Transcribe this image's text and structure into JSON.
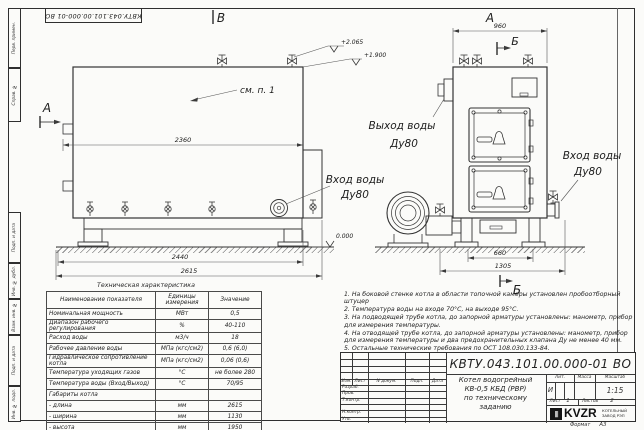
{
  "sheet": {
    "corner_stamp": "КВТУ.043.101.00.000-01 ВО",
    "margin_labels_top": [
      "Перв. примен.",
      "Справ. №"
    ],
    "margin_labels_bottom": [
      "Подп. и дата",
      "Инв. № дубл.",
      "Взам. инв. №",
      "Подп. и дата",
      "Инв. № подл."
    ],
    "format_label": "Формат",
    "format_value": "А3"
  },
  "views": {
    "side": {
      "view_label": "В",
      "section_label": "А",
      "note_ref": "см. п. 1",
      "dim_body": "2360",
      "dim_frame": "2440",
      "dim_overall": "2615",
      "elev_top": "+2.065",
      "elev_nozzle": "+1.900",
      "elev_zero": "0.000",
      "inlet_line1": "Вход воды",
      "inlet_line2": "Ду80"
    },
    "front": {
      "view_label": "А",
      "section_top": "Б",
      "section_bottom": "Б",
      "dim_width": "960",
      "dim_frame": "660",
      "dim_overall": "1305",
      "outlet_line1": "Выход воды",
      "outlet_line2": "Ду80",
      "inlet_line1": "Вход воды",
      "inlet_line2": "Ду80"
    }
  },
  "spec_table": {
    "title": "Техническая характеристика",
    "headers": [
      "Наименование показателя",
      "Единицы измерения",
      "Значение"
    ],
    "rows": [
      [
        "Номинальная мощность",
        "МВт",
        "0,5"
      ],
      [
        "Диапазон рабочего регулирования",
        "%",
        "40-110"
      ],
      [
        "Расход воды",
        "м3/ч",
        "18"
      ],
      [
        "Рабочее давление воды",
        "МПа (кгс/см2)",
        "0,6 (6,0)"
      ],
      [
        "Гидравлическое сопротивление котла",
        "МПа (кгс/см2)",
        "0,06 (0,6)"
      ],
      [
        "Температура уходящих газов",
        "°С",
        "не более 280"
      ],
      [
        "Температура воды (Вход/Выход)",
        "°С",
        "70/95"
      ],
      [
        "Габариты котла",
        "",
        ""
      ],
      [
        "- длина",
        "мм",
        "2615"
      ],
      [
        "- ширина",
        "мм",
        "1130"
      ],
      [
        "- высота",
        "мм",
        "1950"
      ]
    ]
  },
  "notes": [
    "1.  На боковой стенке котла в области топочной камеры установлен пробоотборный штуцер",
    "2.  Температура воды на входе 70°С, на выходе 95°С.",
    "3.  На подводящей трубе котла, до запорной арматуры установлены: манометр, прибор для измерения температуры.",
    "4.  На отводящей трубе котла, до запорной арматуры установлены: манометр, прибор для измерения температуры и два предохранительных клапана Ду не менее 40 мм.",
    "5.  Остальные технические требования по ОСТ 108.030.133-84."
  ],
  "title_block": {
    "doc_number": "КВТУ.043.101.00.000-01 ВО",
    "product_line1": "Котел водогрейный",
    "product_line2": "КВ-0,5 КБД (РВР)",
    "product_line3": "по техническому заданию",
    "col_izm": "Изм.",
    "col_list": "Лист",
    "col_doc": "N докум.",
    "col_sign": "Подп.",
    "col_date": "Дата",
    "row_razrab": "Разраб.",
    "row_prov": "Пров.",
    "row_tkontr": "Т.контр.",
    "row_nkontr": "Н.контр.",
    "row_utv": "Утв.",
    "lit_label": "Лит.",
    "lit_value": "И",
    "mass_label": "Масса",
    "scale_label": "Масштаб",
    "scale_value": "1:15",
    "sheet_label": "Лист",
    "sheet_value": "1",
    "sheets_label": "Листов",
    "sheets_value": "2",
    "logo_mark": "|||",
    "logo_text": "KVZR",
    "company_line1": "КОТЕЛЬНЫЙ",
    "company_line2": "ЗАВОД РЭП"
  }
}
